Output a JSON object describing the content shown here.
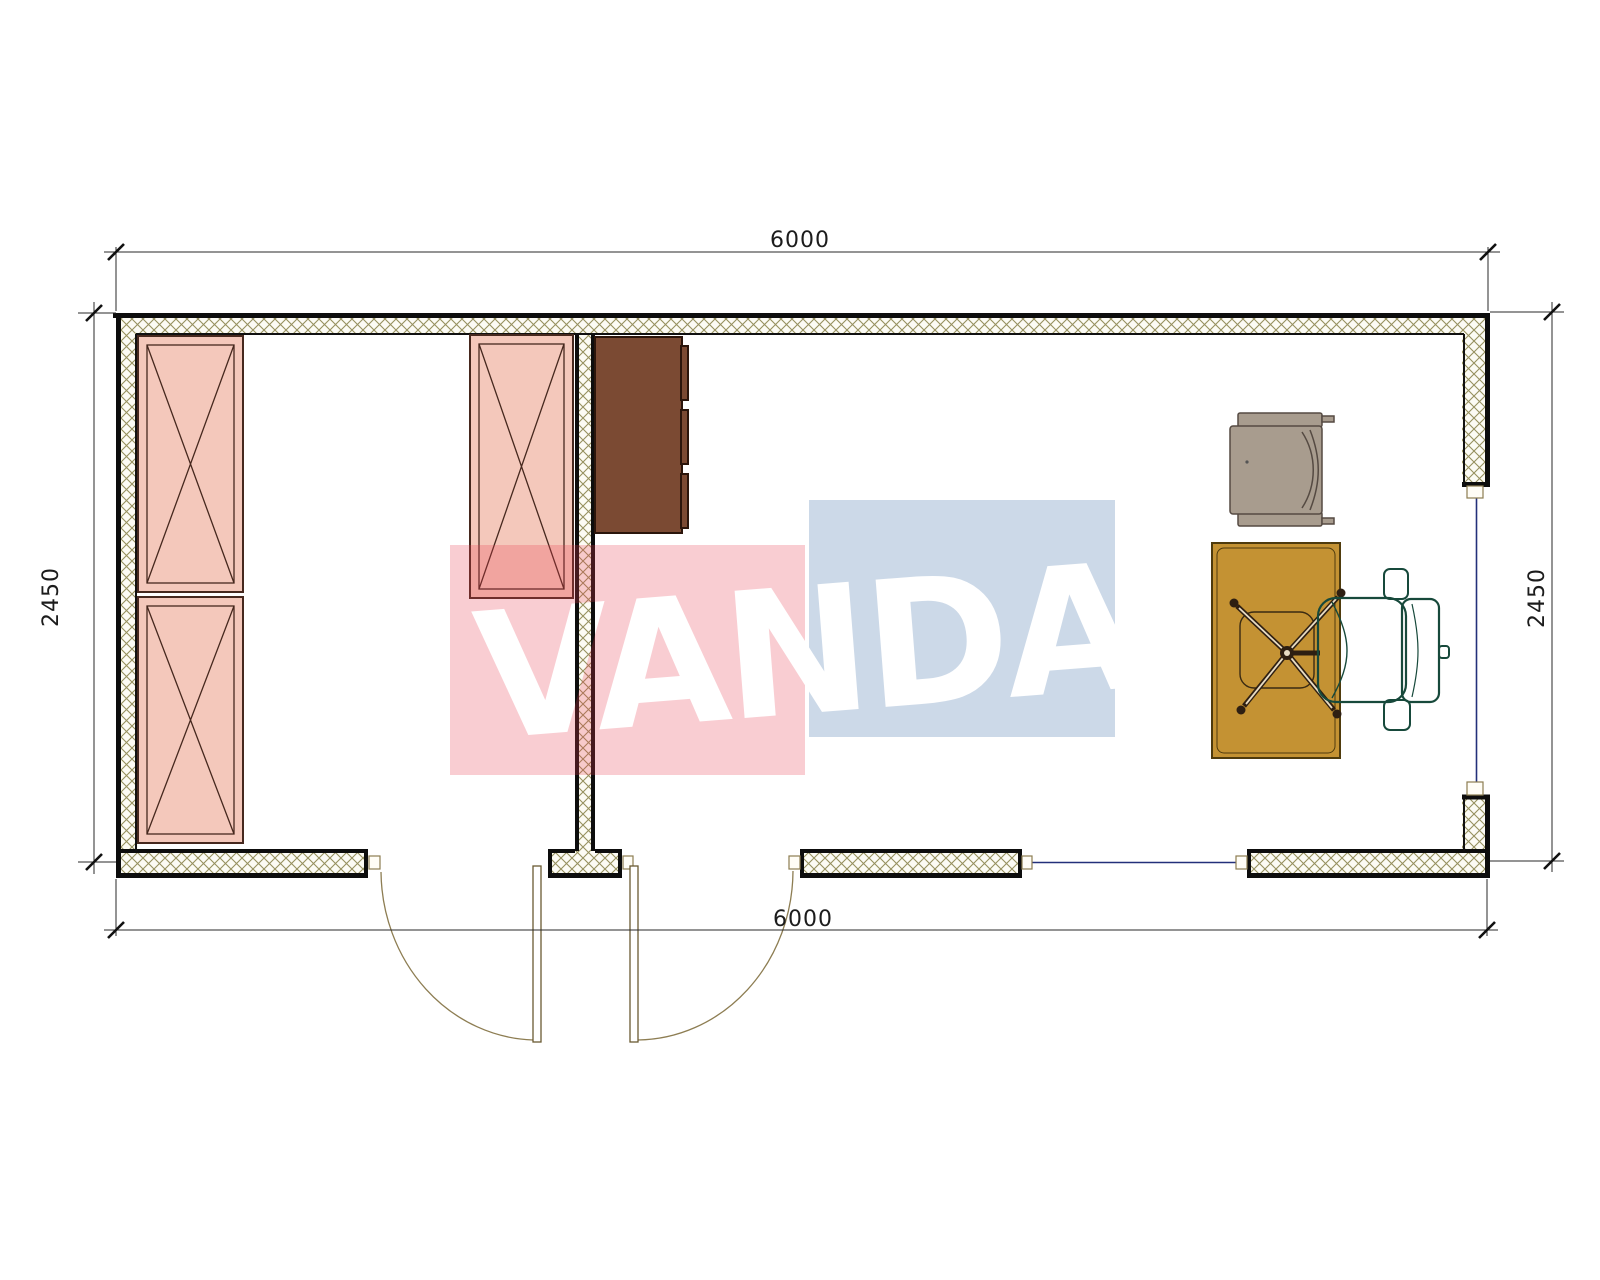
{
  "page_title": "Container office floor plan",
  "dimensions": {
    "top": "6000",
    "bottom": "6000",
    "left": "2450",
    "right": "2450"
  },
  "watermark": {
    "text": "VANDA",
    "pink_overlay": "rgba(230,60,80,0.26)",
    "blue_overlay": "rgba(59,109,167,0.26)"
  },
  "colors": {
    "cabinet_pink": "#f4c8bb",
    "cabinet_brown": "#7b4a33",
    "desk_gold": "#c49233",
    "chair_teal": "#4c9e85",
    "armchair_taupe": "#a89c8e",
    "window_blue": "#23307a",
    "hatch_line": "#96905e",
    "hatch_bg": "#fcfbf4",
    "wall_black": "#0d0d0d"
  }
}
